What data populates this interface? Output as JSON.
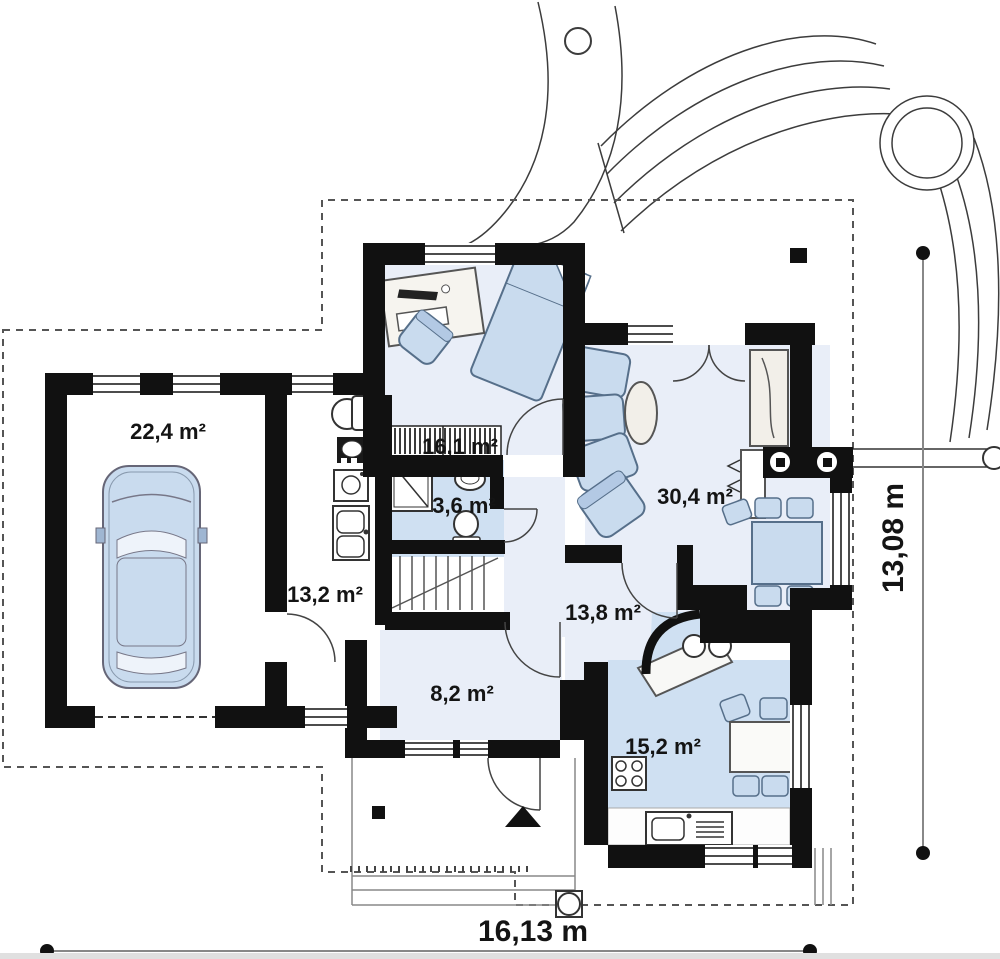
{
  "plan": {
    "rooms": [
      {
        "id": "garage",
        "label": "22,4 m²"
      },
      {
        "id": "bedroom",
        "label": "16,1 m²"
      },
      {
        "id": "bathroom",
        "label": "3,6 m²"
      },
      {
        "id": "utility",
        "label": "13,2 m²"
      },
      {
        "id": "living_room",
        "label": "30,4 m²"
      },
      {
        "id": "hall",
        "label": "13,8 m²"
      },
      {
        "id": "entry",
        "label": "8,2 m²"
      },
      {
        "id": "kitchen",
        "label": "15,2 m²"
      }
    ],
    "dimensions": {
      "width": "16,13 m",
      "height": "13,08 m"
    },
    "colors": {
      "walls": "#111111",
      "floor_light": "#e9eef8",
      "floor_blue": "#cfe0f2",
      "furniture_blue": "#c9dbee",
      "paper": "#ffffff"
    }
  }
}
